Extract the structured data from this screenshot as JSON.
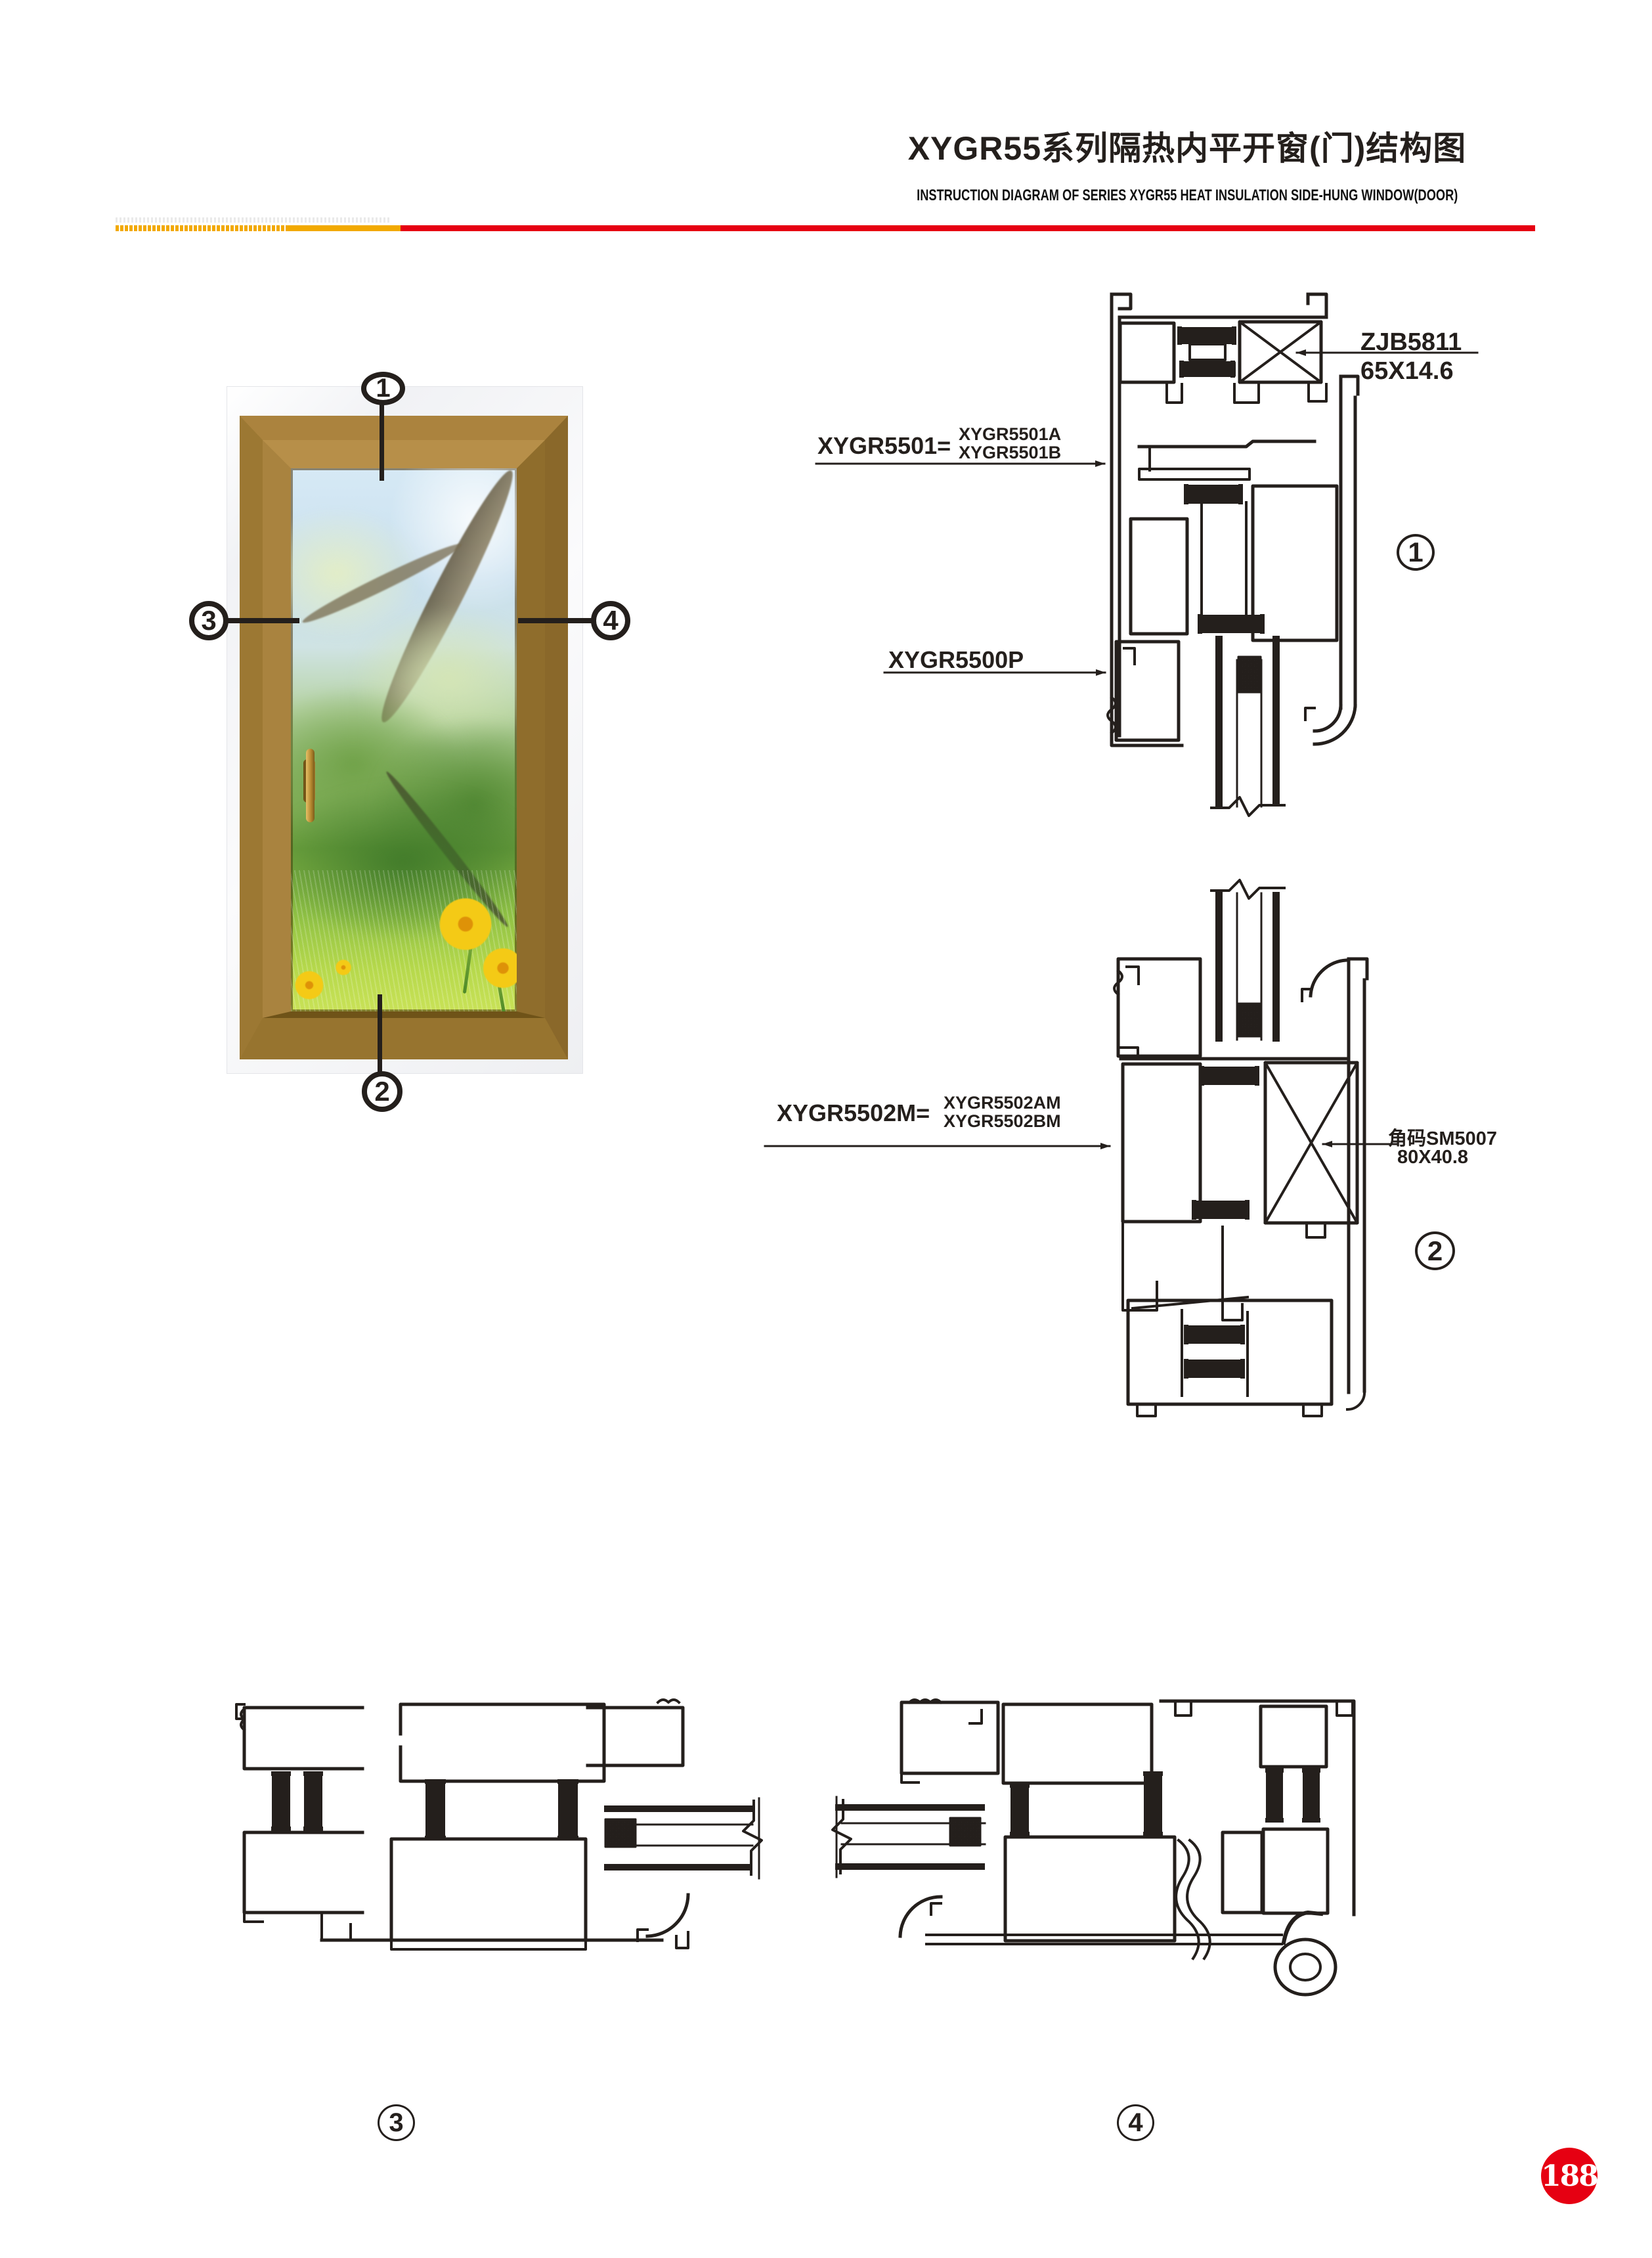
{
  "header": {
    "title_zh": "XYGR55系列隔热内平开窗(门)结构图",
    "title_en": "INSTRUCTION DIAGRAM OF SERIES XYGR55 HEAT INSULATION SIDE-HUNG WINDOW(DOOR)"
  },
  "colors": {
    "accent_red": "#e60012",
    "accent_yellow": "#f2a900",
    "ink": "#241f1c"
  },
  "window_figure": {
    "callouts": {
      "top": "1",
      "bottom": "2",
      "left": "3",
      "right": "4"
    }
  },
  "sections": {
    "s1": {
      "number": "1",
      "labels": {
        "assembly": "XYGR5501=",
        "variant_a": "XYGR5501A",
        "variant_b": "XYGR5501B",
        "bead": "XYGR5500P",
        "corner_code": "ZJB5811",
        "corner_size": "65X14.6"
      }
    },
    "s2": {
      "number": "2",
      "labels": {
        "assembly": "XYGR5502M=",
        "variant_a": "XYGR5502AM",
        "variant_b": "XYGR5502BM",
        "corner_code": "角码SM5007",
        "corner_size": "80X40.8"
      }
    },
    "s3": {
      "number": "3"
    },
    "s4": {
      "number": "4"
    }
  },
  "footer": {
    "page_number": "188"
  }
}
